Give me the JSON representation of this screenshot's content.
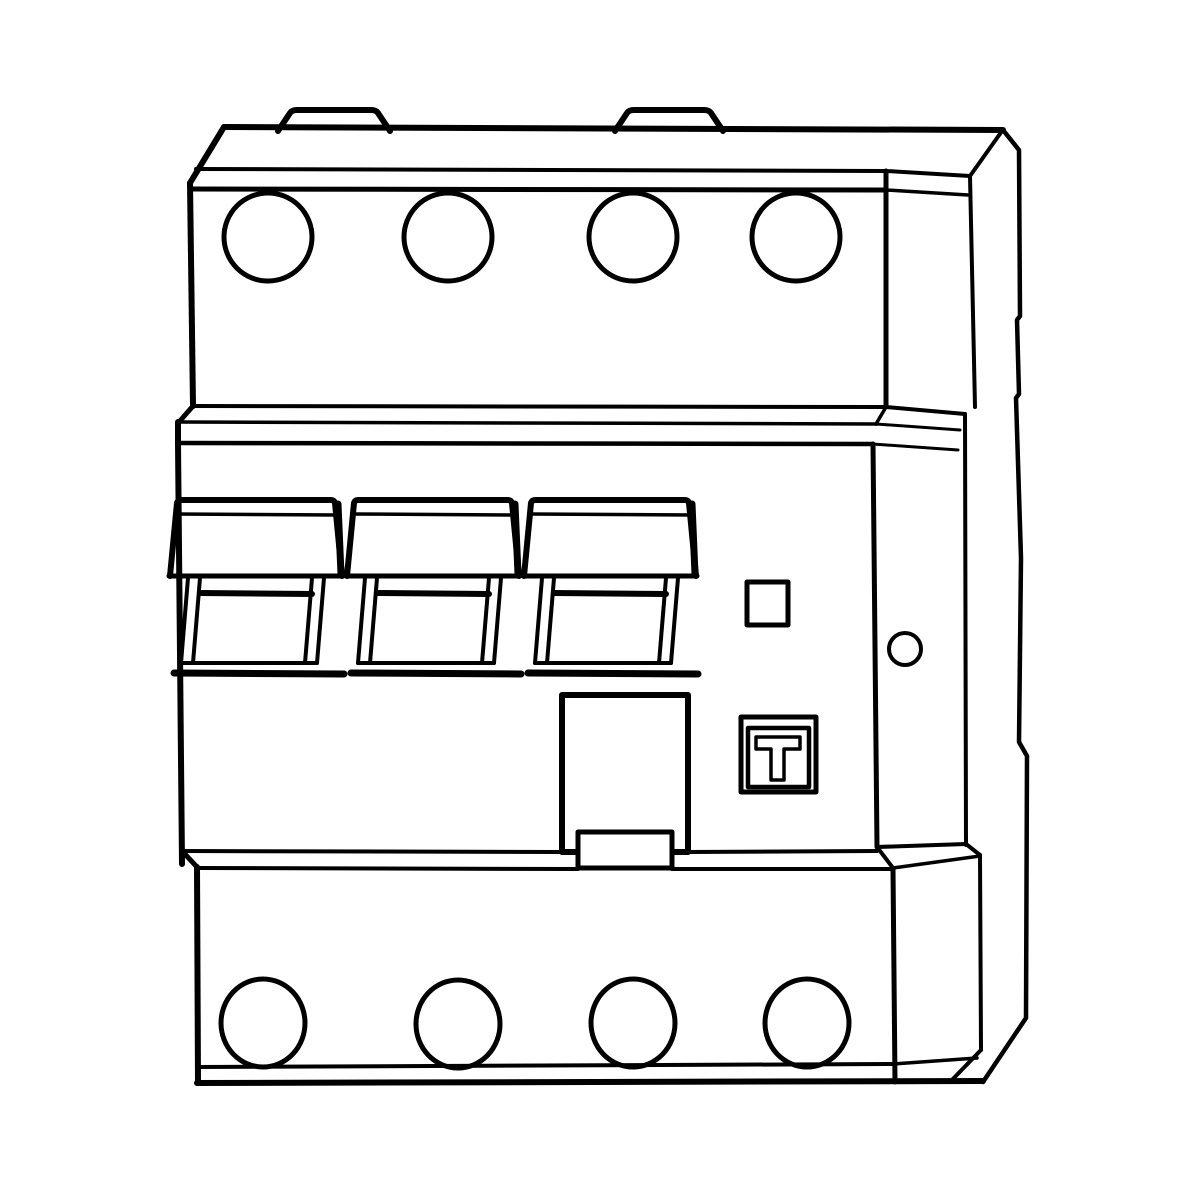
{
  "title": "Technical line drawing of a 4-pole residual current circuit breaker",
  "labels": {
    "test_button_letter": "T"
  },
  "drawing": {
    "canvas": {
      "width": 1200,
      "height": 1200,
      "background": "#ffffff",
      "stroke": "#000000"
    },
    "shapes": [
      {
        "t": "path",
        "n": "din-rail-plate-edge",
        "d": "M 1003,130 L 1019,150 L 1020,316 L 1017,320 L 1019,394 L 1016,398 L 1021,558 L 1019,742 L 1027,756 L 1026,1018 L 983,1082",
        "sw": 4.5
      },
      {
        "t": "line",
        "n": "top-edge",
        "x1": 224,
        "y1": 127,
        "x2": 1003,
        "y2": 130,
        "sw": 6
      },
      {
        "t": "line",
        "n": "top-left-chamfer",
        "x1": 224,
        "y1": 127,
        "x2": 190,
        "y2": 183,
        "sw": 6
      },
      {
        "t": "line",
        "n": "top-block-left-edge",
        "x1": 190,
        "y1": 183,
        "x2": 193,
        "y2": 406,
        "sw": 6
      },
      {
        "t": "line",
        "n": "top-bevel-line-upper",
        "x1": 196,
        "y1": 169,
        "x2": 886,
        "y2": 171,
        "sw": 4
      },
      {
        "t": "line",
        "n": "top-bevel-line-lower",
        "x1": 191,
        "y1": 189,
        "x2": 886,
        "y2": 190,
        "sw": 5
      },
      {
        "t": "line",
        "n": "top-block-right-front-edge",
        "x1": 886,
        "y1": 171,
        "x2": 886,
        "y2": 406,
        "sw": 5
      },
      {
        "t": "line",
        "n": "top-side-back-edge",
        "x1": 970,
        "y1": 176,
        "x2": 1002,
        "y2": 131,
        "sw": 4
      },
      {
        "t": "line",
        "n": "top-side-right-edge",
        "x1": 970,
        "y1": 176,
        "x2": 975,
        "y2": 407,
        "sw": 4
      },
      {
        "t": "line",
        "n": "top-side-bevel-upper",
        "x1": 886,
        "y1": 171,
        "x2": 970,
        "y2": 176,
        "sw": 4
      },
      {
        "t": "line",
        "n": "top-side-bevel-lower",
        "x1": 886,
        "y1": 190,
        "x2": 968,
        "y2": 195,
        "sw": 3.5
      },
      {
        "t": "path",
        "n": "mounting-tab-1",
        "d": "M 278,131 L 290,113 Q 292,110 297,110 L 371,110 Q 376,110 378,113 L 390,131",
        "sw": 6
      },
      {
        "t": "path",
        "n": "mounting-tab-2",
        "d": "M 615,131 L 627,113 Q 629,110 634,110 L 704,110 Q 709,110 711,113 L 723,131",
        "sw": 6
      },
      {
        "t": "circle",
        "n": "terminal-hole-top-1",
        "cx": 268,
        "cy": 237,
        "r": 44,
        "sw": 5
      },
      {
        "t": "circle",
        "n": "terminal-hole-top-2",
        "cx": 448,
        "cy": 237,
        "r": 44,
        "sw": 5
      },
      {
        "t": "circle",
        "n": "terminal-hole-top-3",
        "cx": 633,
        "cy": 237,
        "r": 44,
        "sw": 5
      },
      {
        "t": "circle",
        "n": "terminal-hole-top-4",
        "cx": 796,
        "cy": 237,
        "r": 44,
        "sw": 5
      },
      {
        "t": "line",
        "n": "step-band-back-line",
        "x1": 193,
        "y1": 406,
        "x2": 886,
        "y2": 407,
        "sw": 4
      },
      {
        "t": "line",
        "n": "step-band-left-chamfer",
        "x1": 193,
        "y1": 406,
        "x2": 179,
        "y2": 422,
        "sw": 5
      },
      {
        "t": "line",
        "n": "step-band-mid-line",
        "x1": 179,
        "y1": 422,
        "x2": 877,
        "y2": 424,
        "sw": 3.5
      },
      {
        "t": "line",
        "n": "step-band-right-chamfer",
        "x1": 886,
        "y1": 407,
        "x2": 876,
        "y2": 424,
        "sw": 3.5
      },
      {
        "t": "line",
        "n": "step-band-left-edge",
        "x1": 178,
        "y1": 422,
        "x2": 178,
        "y2": 443,
        "sw": 6
      },
      {
        "t": "line",
        "n": "step-band-front-line",
        "x1": 178,
        "y1": 443,
        "x2": 873,
        "y2": 444,
        "sw": 4.5
      },
      {
        "t": "line",
        "n": "step-band-side-back",
        "x1": 886,
        "y1": 407,
        "x2": 965,
        "y2": 414,
        "sw": 4
      },
      {
        "t": "line",
        "n": "step-band-side-mid",
        "x1": 876,
        "y1": 424,
        "x2": 960,
        "y2": 430,
        "sw": 3
      },
      {
        "t": "line",
        "n": "step-band-side-front",
        "x1": 873,
        "y1": 444,
        "x2": 958,
        "y2": 450,
        "sw": 3
      },
      {
        "t": "line",
        "n": "mid-block-left-edge",
        "x1": 178,
        "y1": 443,
        "x2": 182,
        "y2": 864,
        "sw": 6
      },
      {
        "t": "line",
        "n": "mid-block-right-front-edge",
        "x1": 873,
        "y1": 444,
        "x2": 877,
        "y2": 847,
        "sw": 5
      },
      {
        "t": "line",
        "n": "mid-side-right-edge",
        "x1": 965,
        "y1": 414,
        "x2": 966,
        "y2": 845,
        "sw": 4
      },
      {
        "t": "path",
        "n": "toggle-handle-1-cap",
        "d": "M 170,576 L 177,503 Q 178,500 181,500 L 331,500 Q 334,500 335,503 L 342,576",
        "sw": 6
      },
      {
        "t": "line",
        "n": "toggle-handle-1-cap-shade",
        "x1": 338,
        "y1": 504,
        "x2": 341,
        "y2": 574,
        "sw": 7
      },
      {
        "t": "line",
        "n": "toggle-handle-1-cap-line",
        "x1": 175,
        "y1": 514,
        "x2": 337,
        "y2": 515,
        "sw": 3.5
      },
      {
        "t": "line",
        "n": "toggle-handle-1-cap-bottom",
        "x1": 169,
        "y1": 576,
        "x2": 343,
        "y2": 576,
        "sw": 5
      },
      {
        "t": "line",
        "n": "toggle-handle-1-rail-left-outer",
        "x1": 188,
        "y1": 578,
        "x2": 181,
        "y2": 663,
        "sw": 4
      },
      {
        "t": "line",
        "n": "toggle-handle-1-rail-left-inner",
        "x1": 200,
        "y1": 578,
        "x2": 193,
        "y2": 663,
        "sw": 4
      },
      {
        "t": "line",
        "n": "toggle-handle-1-rail-right-inner",
        "x1": 312,
        "y1": 578,
        "x2": 305,
        "y2": 663,
        "sw": 4
      },
      {
        "t": "line",
        "n": "toggle-handle-1-rail-right-outer",
        "x1": 324,
        "y1": 578,
        "x2": 317,
        "y2": 663,
        "sw": 4
      },
      {
        "t": "line",
        "n": "toggle-handle-1-crossbar",
        "x1": 200,
        "y1": 593,
        "x2": 312,
        "y2": 594,
        "sw": 6
      },
      {
        "t": "line",
        "n": "toggle-handle-1-lip",
        "x1": 181,
        "y1": 663,
        "x2": 317,
        "y2": 663,
        "sw": 4
      },
      {
        "t": "line",
        "n": "toggle-handle-1-bottom",
        "x1": 174,
        "y1": 673,
        "x2": 344,
        "y2": 674,
        "sw": 7
      },
      {
        "t": "path",
        "n": "toggle-handle-2-cap",
        "d": "M 347,576 L 354,503 Q 355,500 358,500 L 508,500 Q 511,500 512,503 L 519,576",
        "sw": 6
      },
      {
        "t": "line",
        "n": "toggle-handle-2-cap-shade",
        "x1": 515,
        "y1": 504,
        "x2": 518,
        "y2": 574,
        "sw": 7
      },
      {
        "t": "line",
        "n": "toggle-handle-2-cap-line",
        "x1": 352,
        "y1": 514,
        "x2": 514,
        "y2": 515,
        "sw": 3.5
      },
      {
        "t": "line",
        "n": "toggle-handle-2-cap-bottom",
        "x1": 346,
        "y1": 576,
        "x2": 520,
        "y2": 576,
        "sw": 5
      },
      {
        "t": "line",
        "n": "toggle-handle-2-rail-left-outer",
        "x1": 365,
        "y1": 578,
        "x2": 358,
        "y2": 663,
        "sw": 4
      },
      {
        "t": "line",
        "n": "toggle-handle-2-rail-left-inner",
        "x1": 377,
        "y1": 578,
        "x2": 370,
        "y2": 663,
        "sw": 4
      },
      {
        "t": "line",
        "n": "toggle-handle-2-rail-right-inner",
        "x1": 489,
        "y1": 578,
        "x2": 482,
        "y2": 663,
        "sw": 4
      },
      {
        "t": "line",
        "n": "toggle-handle-2-rail-right-outer",
        "x1": 501,
        "y1": 578,
        "x2": 494,
        "y2": 663,
        "sw": 4
      },
      {
        "t": "line",
        "n": "toggle-handle-2-crossbar",
        "x1": 377,
        "y1": 593,
        "x2": 489,
        "y2": 594,
        "sw": 6
      },
      {
        "t": "line",
        "n": "toggle-handle-2-lip",
        "x1": 358,
        "y1": 663,
        "x2": 494,
        "y2": 663,
        "sw": 4
      },
      {
        "t": "line",
        "n": "toggle-handle-2-bottom",
        "x1": 351,
        "y1": 673,
        "x2": 521,
        "y2": 674,
        "sw": 7
      },
      {
        "t": "path",
        "n": "toggle-handle-3-cap",
        "d": "M 524,576 L 531,503 Q 532,500 535,500 L 685,500 Q 688,500 689,503 L 696,576",
        "sw": 6
      },
      {
        "t": "line",
        "n": "toggle-handle-3-cap-shade",
        "x1": 692,
        "y1": 504,
        "x2": 695,
        "y2": 574,
        "sw": 7
      },
      {
        "t": "line",
        "n": "toggle-handle-3-cap-line",
        "x1": 529,
        "y1": 514,
        "x2": 691,
        "y2": 515,
        "sw": 3.5
      },
      {
        "t": "line",
        "n": "toggle-handle-3-cap-bottom",
        "x1": 523,
        "y1": 576,
        "x2": 697,
        "y2": 576,
        "sw": 5
      },
      {
        "t": "line",
        "n": "toggle-handle-3-rail-left-outer",
        "x1": 542,
        "y1": 578,
        "x2": 535,
        "y2": 663,
        "sw": 4
      },
      {
        "t": "line",
        "n": "toggle-handle-3-rail-left-inner",
        "x1": 554,
        "y1": 578,
        "x2": 547,
        "y2": 663,
        "sw": 4
      },
      {
        "t": "line",
        "n": "toggle-handle-3-rail-right-inner",
        "x1": 666,
        "y1": 578,
        "x2": 659,
        "y2": 663,
        "sw": 4
      },
      {
        "t": "line",
        "n": "toggle-handle-3-rail-right-outer",
        "x1": 678,
        "y1": 578,
        "x2": 671,
        "y2": 663,
        "sw": 4
      },
      {
        "t": "line",
        "n": "toggle-handle-3-crossbar",
        "x1": 554,
        "y1": 593,
        "x2": 666,
        "y2": 594,
        "sw": 6
      },
      {
        "t": "line",
        "n": "toggle-handle-3-lip",
        "x1": 535,
        "y1": 663,
        "x2": 671,
        "y2": 663,
        "sw": 4
      },
      {
        "t": "line",
        "n": "toggle-handle-3-bottom",
        "x1": 528,
        "y1": 673,
        "x2": 698,
        "y2": 674,
        "sw": 7
      },
      {
        "t": "rect",
        "n": "center-plate",
        "x": 562,
        "y": 695,
        "w": 126,
        "h": 157,
        "sw": 6,
        "fill": "#ffffff"
      },
      {
        "t": "line",
        "n": "mid-bottom-back-line-a",
        "x1": 182,
        "y1": 851,
        "x2": 562,
        "y2": 852,
        "sw": 4
      },
      {
        "t": "line",
        "n": "mid-bottom-back-line-b",
        "x1": 688,
        "y1": 852,
        "x2": 877,
        "y2": 851,
        "sw": 4
      },
      {
        "t": "line",
        "n": "mid-bottom-left-chamfer",
        "x1": 182,
        "y1": 851,
        "x2": 197,
        "y2": 867,
        "sw": 5
      },
      {
        "t": "line",
        "n": "mid-bottom-front-line-a",
        "x1": 197,
        "y1": 868,
        "x2": 578,
        "y2": 869,
        "sw": 4
      },
      {
        "t": "line",
        "n": "mid-bottom-front-line-b",
        "x1": 672,
        "y1": 869,
        "x2": 893,
        "y2": 869,
        "sw": 4
      },
      {
        "t": "line",
        "n": "mid-bottom-right-chamfer",
        "x1": 877,
        "y1": 847,
        "x2": 893,
        "y2": 868,
        "sw": 4
      },
      {
        "t": "line",
        "n": "mid-side-bottom-edge",
        "x1": 877,
        "y1": 847,
        "x2": 966,
        "y2": 844,
        "sw": 4
      },
      {
        "t": "line",
        "n": "mid-side-bottom-chamfer",
        "x1": 966,
        "y1": 844,
        "x2": 980,
        "y2": 855,
        "sw": 4
      },
      {
        "t": "line",
        "n": "bottom-side-top-edge",
        "x1": 893,
        "y1": 868,
        "x2": 980,
        "y2": 856,
        "sw": 3.5
      },
      {
        "t": "rect",
        "n": "center-plate-clip",
        "x": 578,
        "y": 832,
        "w": 94,
        "h": 36,
        "sw": 5,
        "fill": "#ffffff"
      },
      {
        "t": "rect",
        "n": "indicator-window",
        "x": 747,
        "y": 582,
        "w": 41,
        "h": 43,
        "sw": 5
      },
      {
        "t": "circle",
        "n": "side-seal-hole",
        "cx": 905,
        "cy": 649,
        "r": 16,
        "sw": 4
      },
      {
        "t": "rect",
        "n": "test-button-outer",
        "x": 741,
        "y": 717,
        "w": 75,
        "h": 75,
        "sw": 5,
        "fill": "#ffffff"
      },
      {
        "t": "rect",
        "n": "test-button-face",
        "x": 748,
        "y": 728,
        "w": 61,
        "h": 59,
        "sw": 4.5
      },
      {
        "t": "path",
        "n": "test-button-letter",
        "d": "M 756,737 L 800,737 L 800,749 L 784,749 L 784,780 L 771,780 L 771,749 L 756,749 Z",
        "sw": 3.5
      },
      {
        "t": "line",
        "n": "bottom-block-left-edge",
        "x1": 197,
        "y1": 867,
        "x2": 198,
        "y2": 1083,
        "sw": 6
      },
      {
        "t": "line",
        "n": "bottom-block-right-front-edge",
        "x1": 893,
        "y1": 869,
        "x2": 895,
        "y2": 1082,
        "sw": 5
      },
      {
        "t": "line",
        "n": "bottom-side-right-edge",
        "x1": 980,
        "y1": 855,
        "x2": 981,
        "y2": 1050,
        "sw": 4
      },
      {
        "t": "line",
        "n": "bottom-side-chamfer",
        "x1": 981,
        "y1": 1050,
        "x2": 950,
        "y2": 1082,
        "sw": 4
      },
      {
        "t": "line",
        "n": "bottom-bevel-line",
        "x1": 198,
        "y1": 1067,
        "x2": 893,
        "y2": 1064,
        "sw": 4
      },
      {
        "t": "line",
        "n": "bottom-bevel-side-line",
        "x1": 893,
        "y1": 1064,
        "x2": 977,
        "y2": 1058,
        "sw": 3.5
      },
      {
        "t": "line",
        "n": "bottom-edge",
        "x1": 197,
        "y1": 1083,
        "x2": 983,
        "y2": 1081,
        "sw": 6
      },
      {
        "t": "ellipse",
        "n": "terminal-hole-bottom-1",
        "cx": 263,
        "cy": 1023,
        "rx": 42,
        "ry": 44,
        "sw": 5
      },
      {
        "t": "ellipse",
        "n": "terminal-hole-bottom-2",
        "cx": 458,
        "cy": 1024,
        "rx": 42,
        "ry": 44,
        "sw": 5
      },
      {
        "t": "ellipse",
        "n": "terminal-hole-bottom-3",
        "cx": 633,
        "cy": 1023,
        "rx": 42,
        "ry": 44,
        "sw": 5
      },
      {
        "t": "ellipse",
        "n": "terminal-hole-bottom-4",
        "cx": 807,
        "cy": 1023,
        "rx": 42,
        "ry": 44,
        "sw": 5
      }
    ]
  }
}
